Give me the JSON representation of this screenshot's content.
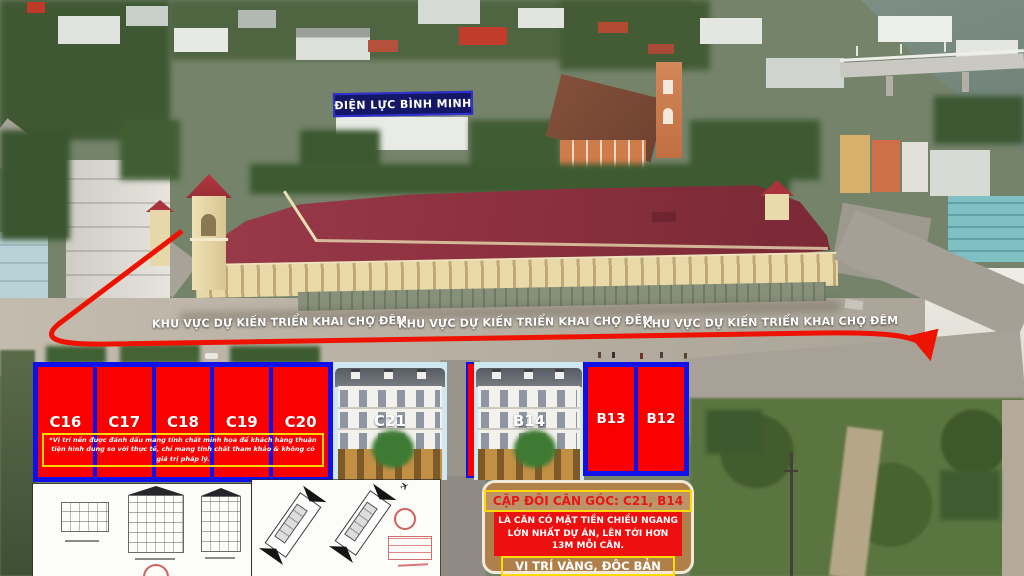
{
  "annotations": {
    "power_station_label": "ĐIỆN LỰC BÌNH MINH",
    "night_market_labels": [
      "KHU VỰC DỰ KIẾN TRIỂN KHAI CHỢ ĐÊM",
      "KHU VỰC DỰ KIẾN TRIỂN KHAI CHỢ ĐÊM",
      "KHU VỰC DỰ KIẾN TRIỂN KHAI CHỢ ĐÊM"
    ]
  },
  "lots": {
    "c_block": [
      "C16",
      "C17",
      "C18",
      "C19",
      "C20"
    ],
    "b_block": [
      "B13",
      "B12"
    ],
    "render_labels": [
      "C21",
      "B14"
    ],
    "disclaimer": "*Vị trí nền được đánh dấu mang tính chất minh họa để khách hàng thuận tiện hình dung so với thực tế, chỉ mang tính chất tham khảo & không có giá trị pháp lý."
  },
  "promo": {
    "heading": "CẶP ĐÔI CĂN GÓC: C21, B14",
    "body": "LÀ CĂN CÓ MẶT TIỀN CHIỀU NGANG LỚN NHẤT DỰ ÁN, LÊN TỚI HƠN 13M MỖI CĂN.",
    "footer": "VỊ TRÍ VÀNG, ĐỘC BẢN"
  },
  "colors": {
    "lot_red": "#fb0000",
    "lot_border_blue": "#1010e8",
    "accent_yellow": "#ffd800",
    "promo_tan": "#b0804b",
    "arrow_red": "#ee1200",
    "label_navy": "#141766",
    "market_roof_maroon": "#8e3140"
  }
}
